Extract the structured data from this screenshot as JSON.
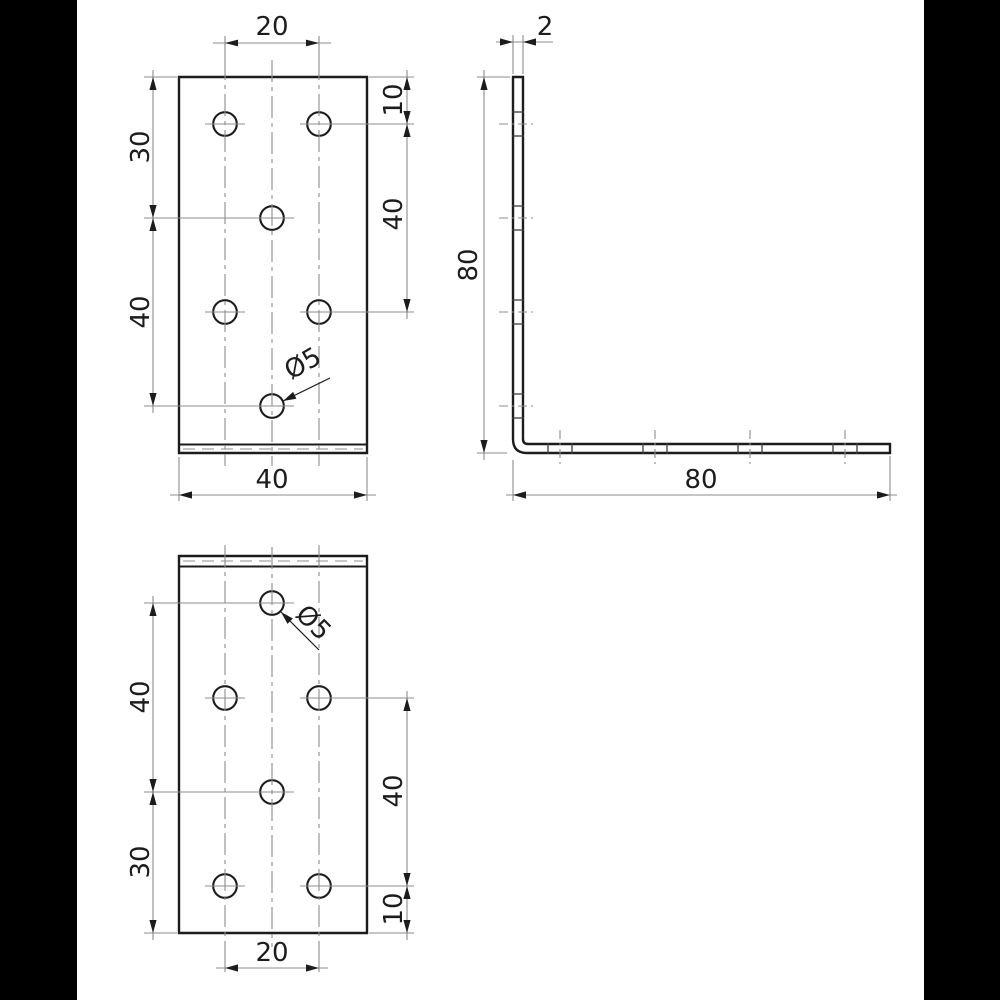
{
  "page": {
    "background": "#ffffff",
    "letterbox_color": "#000000"
  },
  "drawing": {
    "kind": "technical drawing, angle bracket with perforated flanges, three views",
    "colors": {
      "line": "#1c1c1c",
      "thin_line": "#8c8c8c",
      "background": "#ffffff"
    },
    "views": {
      "flange_top": {
        "dims": {
          "top": "20",
          "left_upper": "30",
          "left_lower": "40",
          "right_upper": "10",
          "right_lower": "40",
          "bottom": "40",
          "hole": "Ø5"
        }
      },
      "profile": {
        "dims": {
          "top": "2",
          "left": "80",
          "bottom": "80"
        }
      },
      "flange_bottom": {
        "dims": {
          "left_upper": "40",
          "left_lower": "30",
          "right_upper": "40",
          "right_lower": "10",
          "bottom": "20",
          "hole": "Ø5"
        }
      }
    }
  }
}
